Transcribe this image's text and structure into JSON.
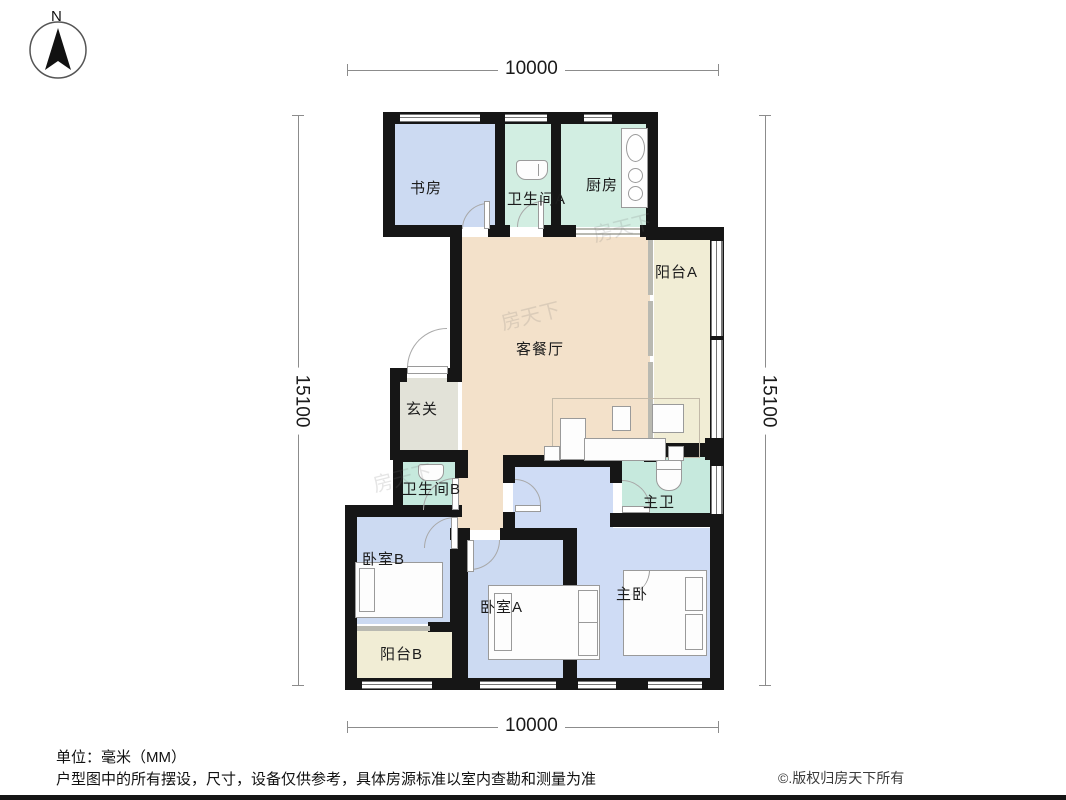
{
  "compass": {
    "north_label": "N"
  },
  "dimensions": {
    "top": {
      "value": "10000"
    },
    "bottom": {
      "value": "10000"
    },
    "left": {
      "value": "15100"
    },
    "right": {
      "value": "15100"
    }
  },
  "rooms": {
    "study": {
      "label": "书房"
    },
    "bathroom_a": {
      "label": "卫生间A"
    },
    "kitchen": {
      "label": "厨房"
    },
    "balcony_a": {
      "label": "阳台A"
    },
    "living_dining": {
      "label": "客餐厅"
    },
    "foyer": {
      "label": "玄关"
    },
    "bathroom_b": {
      "label": "卫生间B"
    },
    "master_bath": {
      "label": "主卫"
    },
    "bedroom_b": {
      "label": "卧室B"
    },
    "bedroom_a": {
      "label": "卧室A"
    },
    "master_bedroom": {
      "label": "主卧"
    },
    "balcony_b": {
      "label": "阳台B"
    }
  },
  "watermark": {
    "text": "房天下"
  },
  "footer": {
    "unit_note": "单位：毫米（MM）",
    "disclaimer": "户型图中的所有摆设，尺寸，设备仅供参考，具体房源标准以室内查勘和测量为准",
    "copyright": "©.版权归房天下所有"
  },
  "colors": {
    "wall": "#161616",
    "room_blue": "#ccdaf2",
    "room_teal": "#d2eee2",
    "room_teal_dark": "#c6e9dd",
    "room_cream": "#f1edd5",
    "room_tan": "#f3e1ca",
    "room_gray_green": "#e2e2d8",
    "dimension_line": "#8c8c8c"
  }
}
